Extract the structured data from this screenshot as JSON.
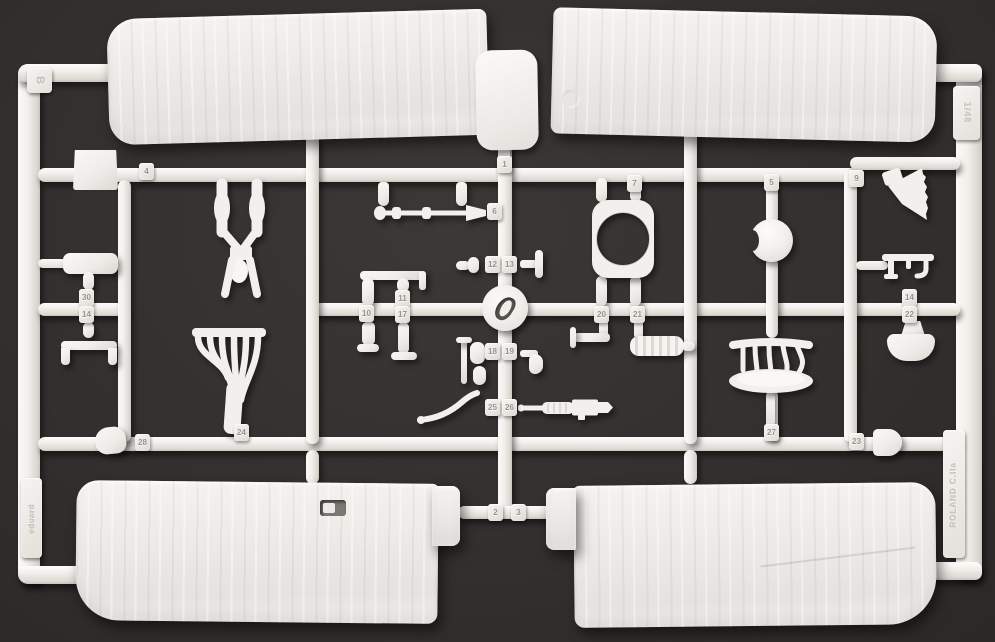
{
  "meta": {
    "subject": "Photograph of a white injection-molded model kit sprue (parts frame) on a dark grey background",
    "plastic_color": "#f2f0ec",
    "background_color": "#34312e"
  },
  "sprue": {
    "frame_letter": "B",
    "scale_label": "1/48",
    "kit_label": "ROLAND C.IIa",
    "brand_label": "eduard"
  },
  "part_tags": [
    {
      "n": "4",
      "x": 139,
      "y": 163
    },
    {
      "n": "30",
      "x": 79,
      "y": 289
    },
    {
      "n": "14",
      "x": 79,
      "y": 306
    },
    {
      "n": "24",
      "x": 234,
      "y": 424
    },
    {
      "n": "1",
      "x": 497,
      "y": 156
    },
    {
      "n": "6",
      "x": 487,
      "y": 203
    },
    {
      "n": "12",
      "x": 485,
      "y": 256
    },
    {
      "n": "13",
      "x": 502,
      "y": 256
    },
    {
      "n": "10",
      "x": 359,
      "y": 305
    },
    {
      "n": "11",
      "x": 395,
      "y": 290
    },
    {
      "n": "17",
      "x": 395,
      "y": 306
    },
    {
      "n": "18",
      "x": 485,
      "y": 343
    },
    {
      "n": "19",
      "x": 502,
      "y": 343
    },
    {
      "n": "25",
      "x": 485,
      "y": 399
    },
    {
      "n": "26",
      "x": 502,
      "y": 399
    },
    {
      "n": "7",
      "x": 627,
      "y": 175
    },
    {
      "n": "20",
      "x": 594,
      "y": 306
    },
    {
      "n": "21",
      "x": 630,
      "y": 306
    },
    {
      "n": "5",
      "x": 764,
      "y": 174
    },
    {
      "n": "9",
      "x": 849,
      "y": 170
    },
    {
      "n": "14",
      "x": 902,
      "y": 289
    },
    {
      "n": "22",
      "x": 902,
      "y": 306
    },
    {
      "n": "27",
      "x": 764,
      "y": 424
    },
    {
      "n": "23",
      "x": 849,
      "y": 433
    },
    {
      "n": "28",
      "x": 135,
      "y": 434
    },
    {
      "n": "2",
      "x": 488,
      "y": 504
    },
    {
      "n": "3",
      "x": 511,
      "y": 504
    }
  ]
}
